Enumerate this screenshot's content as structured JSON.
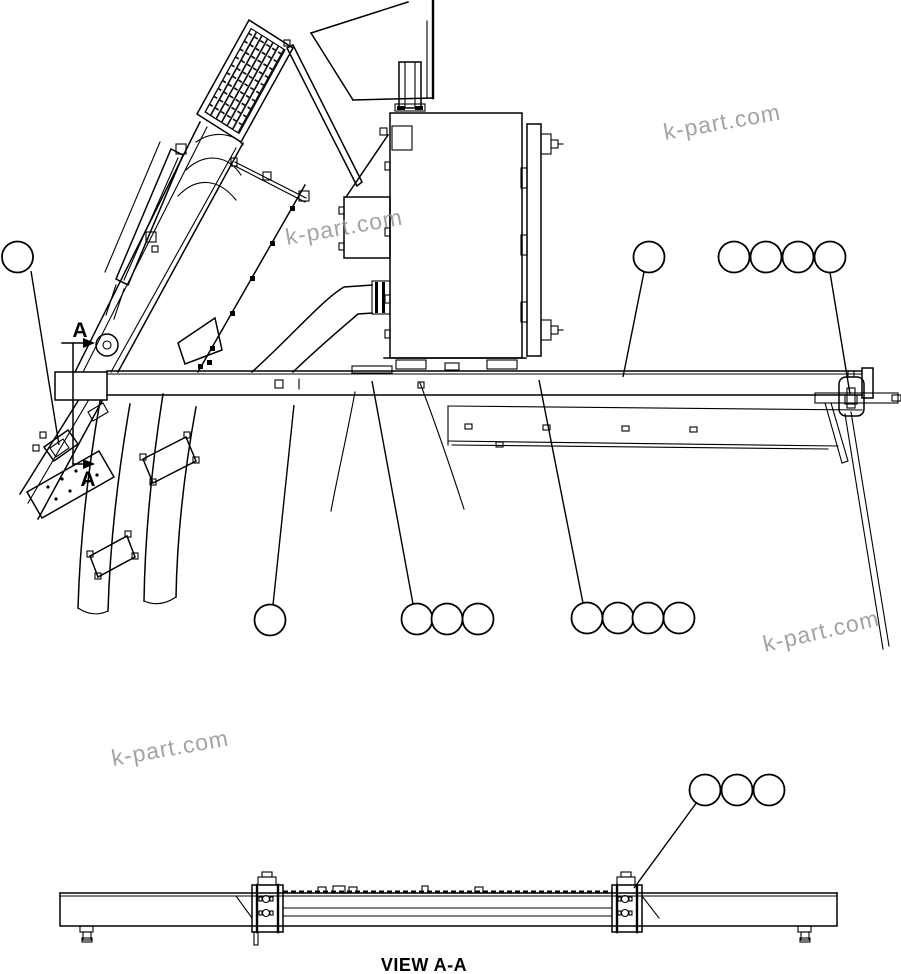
{
  "drawing": {
    "kind": "machinery-parts-line-diagram",
    "background": "#ffffff",
    "line_color": "#000000",
    "watermark": {
      "text": "k-part.com",
      "color": "#8d8d8d",
      "count": 4
    },
    "section_label": "A",
    "view_label": "VIEW A-A",
    "callouts": {
      "style": "empty-circles",
      "groups": [
        {
          "id": "left-single",
          "circles": 1
        },
        {
          "id": "top-right-single",
          "circles": 1
        },
        {
          "id": "top-right-quad",
          "circles": 4
        },
        {
          "id": "bottom-left-single",
          "circles": 1
        },
        {
          "id": "bottom-mid-triple",
          "circles": 3
        },
        {
          "id": "bottom-right-quad",
          "circles": 4
        },
        {
          "id": "view-aa-triple",
          "circles": 3
        }
      ]
    }
  }
}
